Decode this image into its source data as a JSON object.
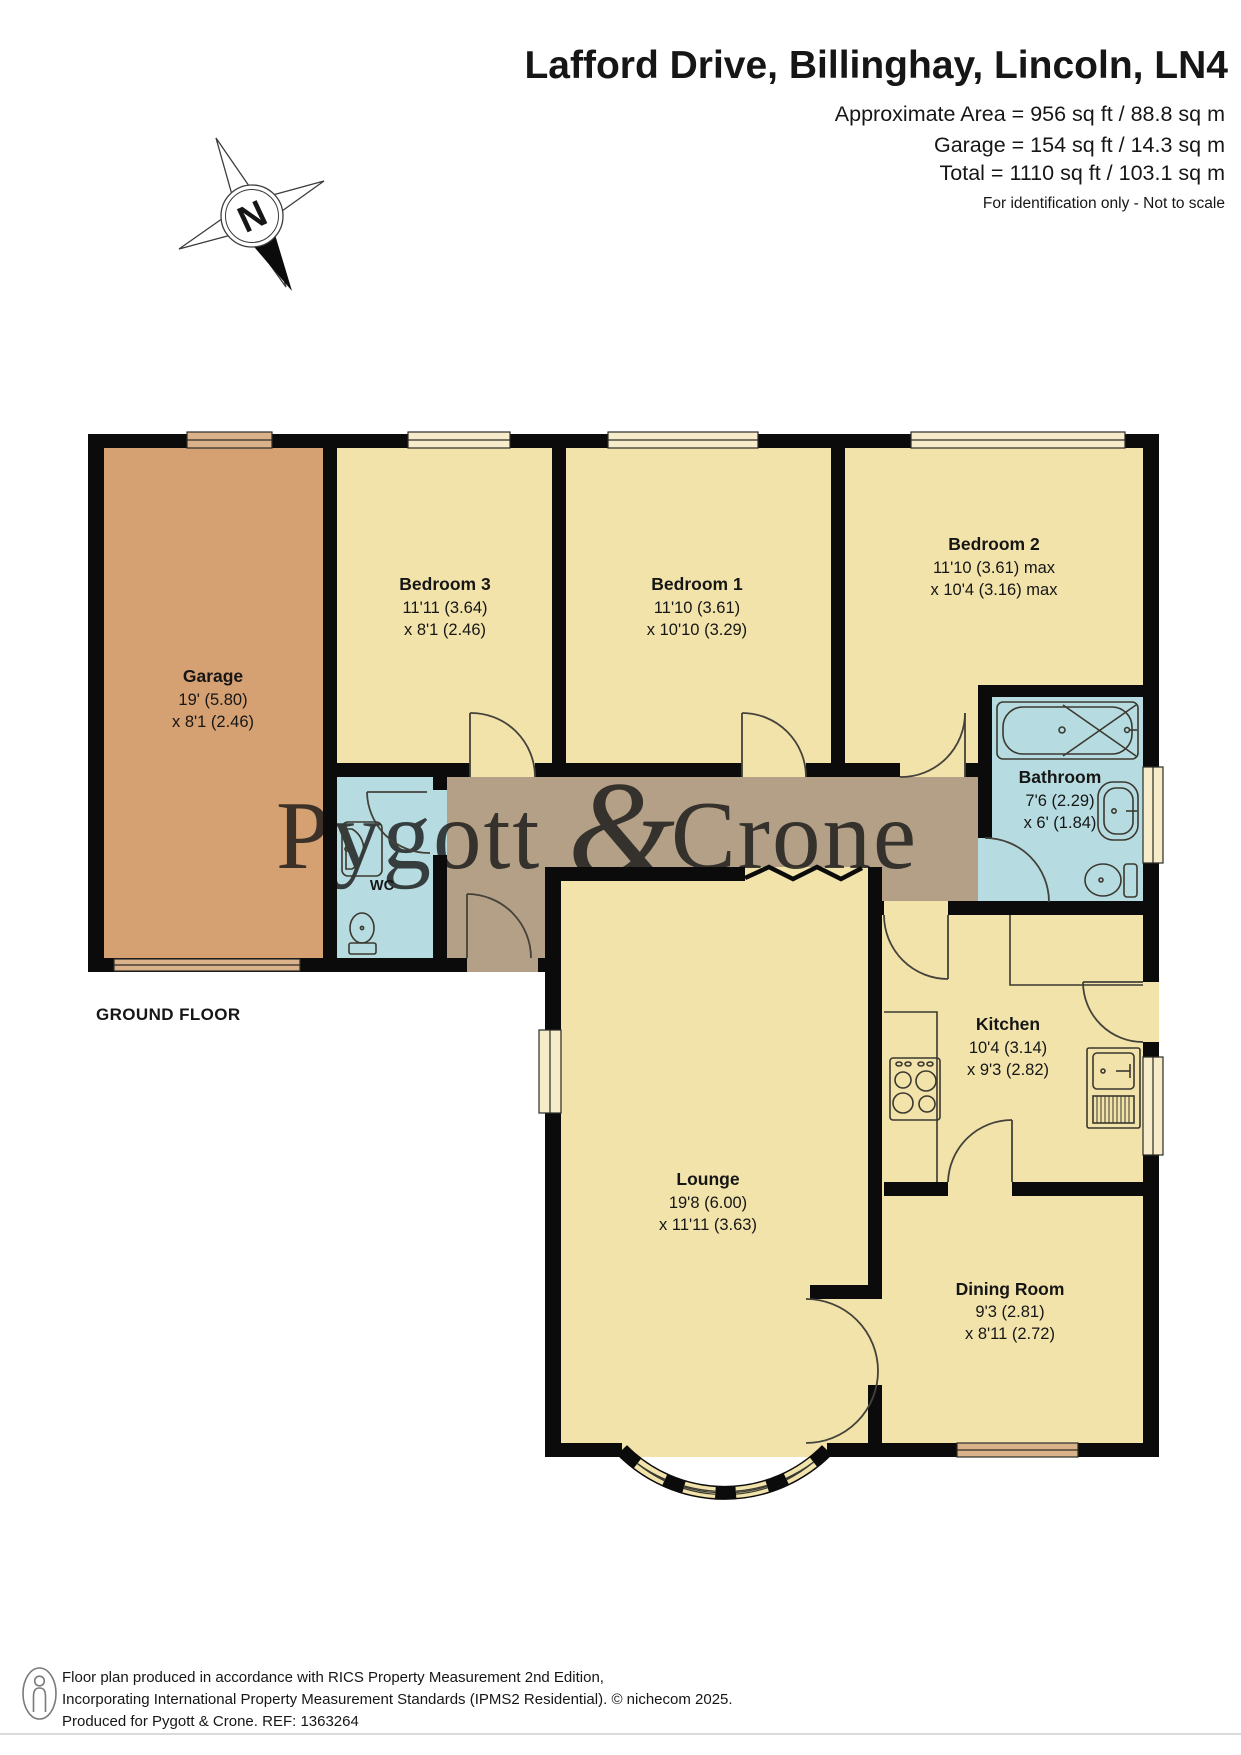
{
  "header": {
    "title": "Lafford Drive, Billinghay, Lincoln, LN4",
    "area_line1": "Approximate Area = 956 sq ft / 88.8 sq m",
    "area_line2": "Garage = 154 sq ft / 14.3 sq m",
    "area_line3": "Total = 1110 sq ft / 103.1 sq m",
    "note": "For identification only - Not to scale"
  },
  "compass": {
    "label": "N"
  },
  "floor_label": "GROUND FLOOR",
  "watermark": {
    "part1": "Pygott ",
    "amp": "&",
    "part2": "Crone"
  },
  "rooms": {
    "garage": {
      "name": "Garage",
      "dim1": "19' (5.80)",
      "dim2": "x 8'1 (2.46)"
    },
    "bedroom3": {
      "name": "Bedroom 3",
      "dim1": "11'11 (3.64)",
      "dim2": "x 8'1 (2.46)"
    },
    "bedroom1": {
      "name": "Bedroom 1",
      "dim1": "11'10 (3.61)",
      "dim2": "x 10'10 (3.29)"
    },
    "bedroom2": {
      "name": "Bedroom 2",
      "dim1": "11'10 (3.61) max",
      "dim2": "x 10'4 (3.16) max"
    },
    "bathroom": {
      "name": "Bathroom",
      "dim1": "7'6 (2.29)",
      "dim2": "x 6' (1.84)"
    },
    "wc": {
      "name": "WC"
    },
    "kitchen": {
      "name": "Kitchen",
      "dim1": "10'4 (3.14)",
      "dim2": "x 9'3 (2.82)"
    },
    "lounge": {
      "name": "Lounge",
      "dim1": "19'8 (6.00)",
      "dim2": "x 11'11 (3.63)"
    },
    "dining": {
      "name": "Dining Room",
      "dim1": "9'3 (2.81)",
      "dim2": "x 8'11 (2.72)"
    }
  },
  "footer": {
    "line1": "Floor plan produced in accordance with RICS Property Measurement 2nd Edition,",
    "line2": "Incorporating International Property Measurement Standards (IPMS2 Residential).   © nichecom 2025.",
    "line3": "Produced for Pygott & Crone.   REF:  1363264"
  },
  "colors": {
    "room_yellow": "#f2e3ab",
    "garage_orange": "#d6a172",
    "wet_blue": "#b6dce1",
    "hall_brown": "#b3a086",
    "window_tan": "#d9b28a",
    "wall_black": "#0b0b0b",
    "watermark_gray": "#8b8b83",
    "footer_gray": "#6b6b6b"
  }
}
